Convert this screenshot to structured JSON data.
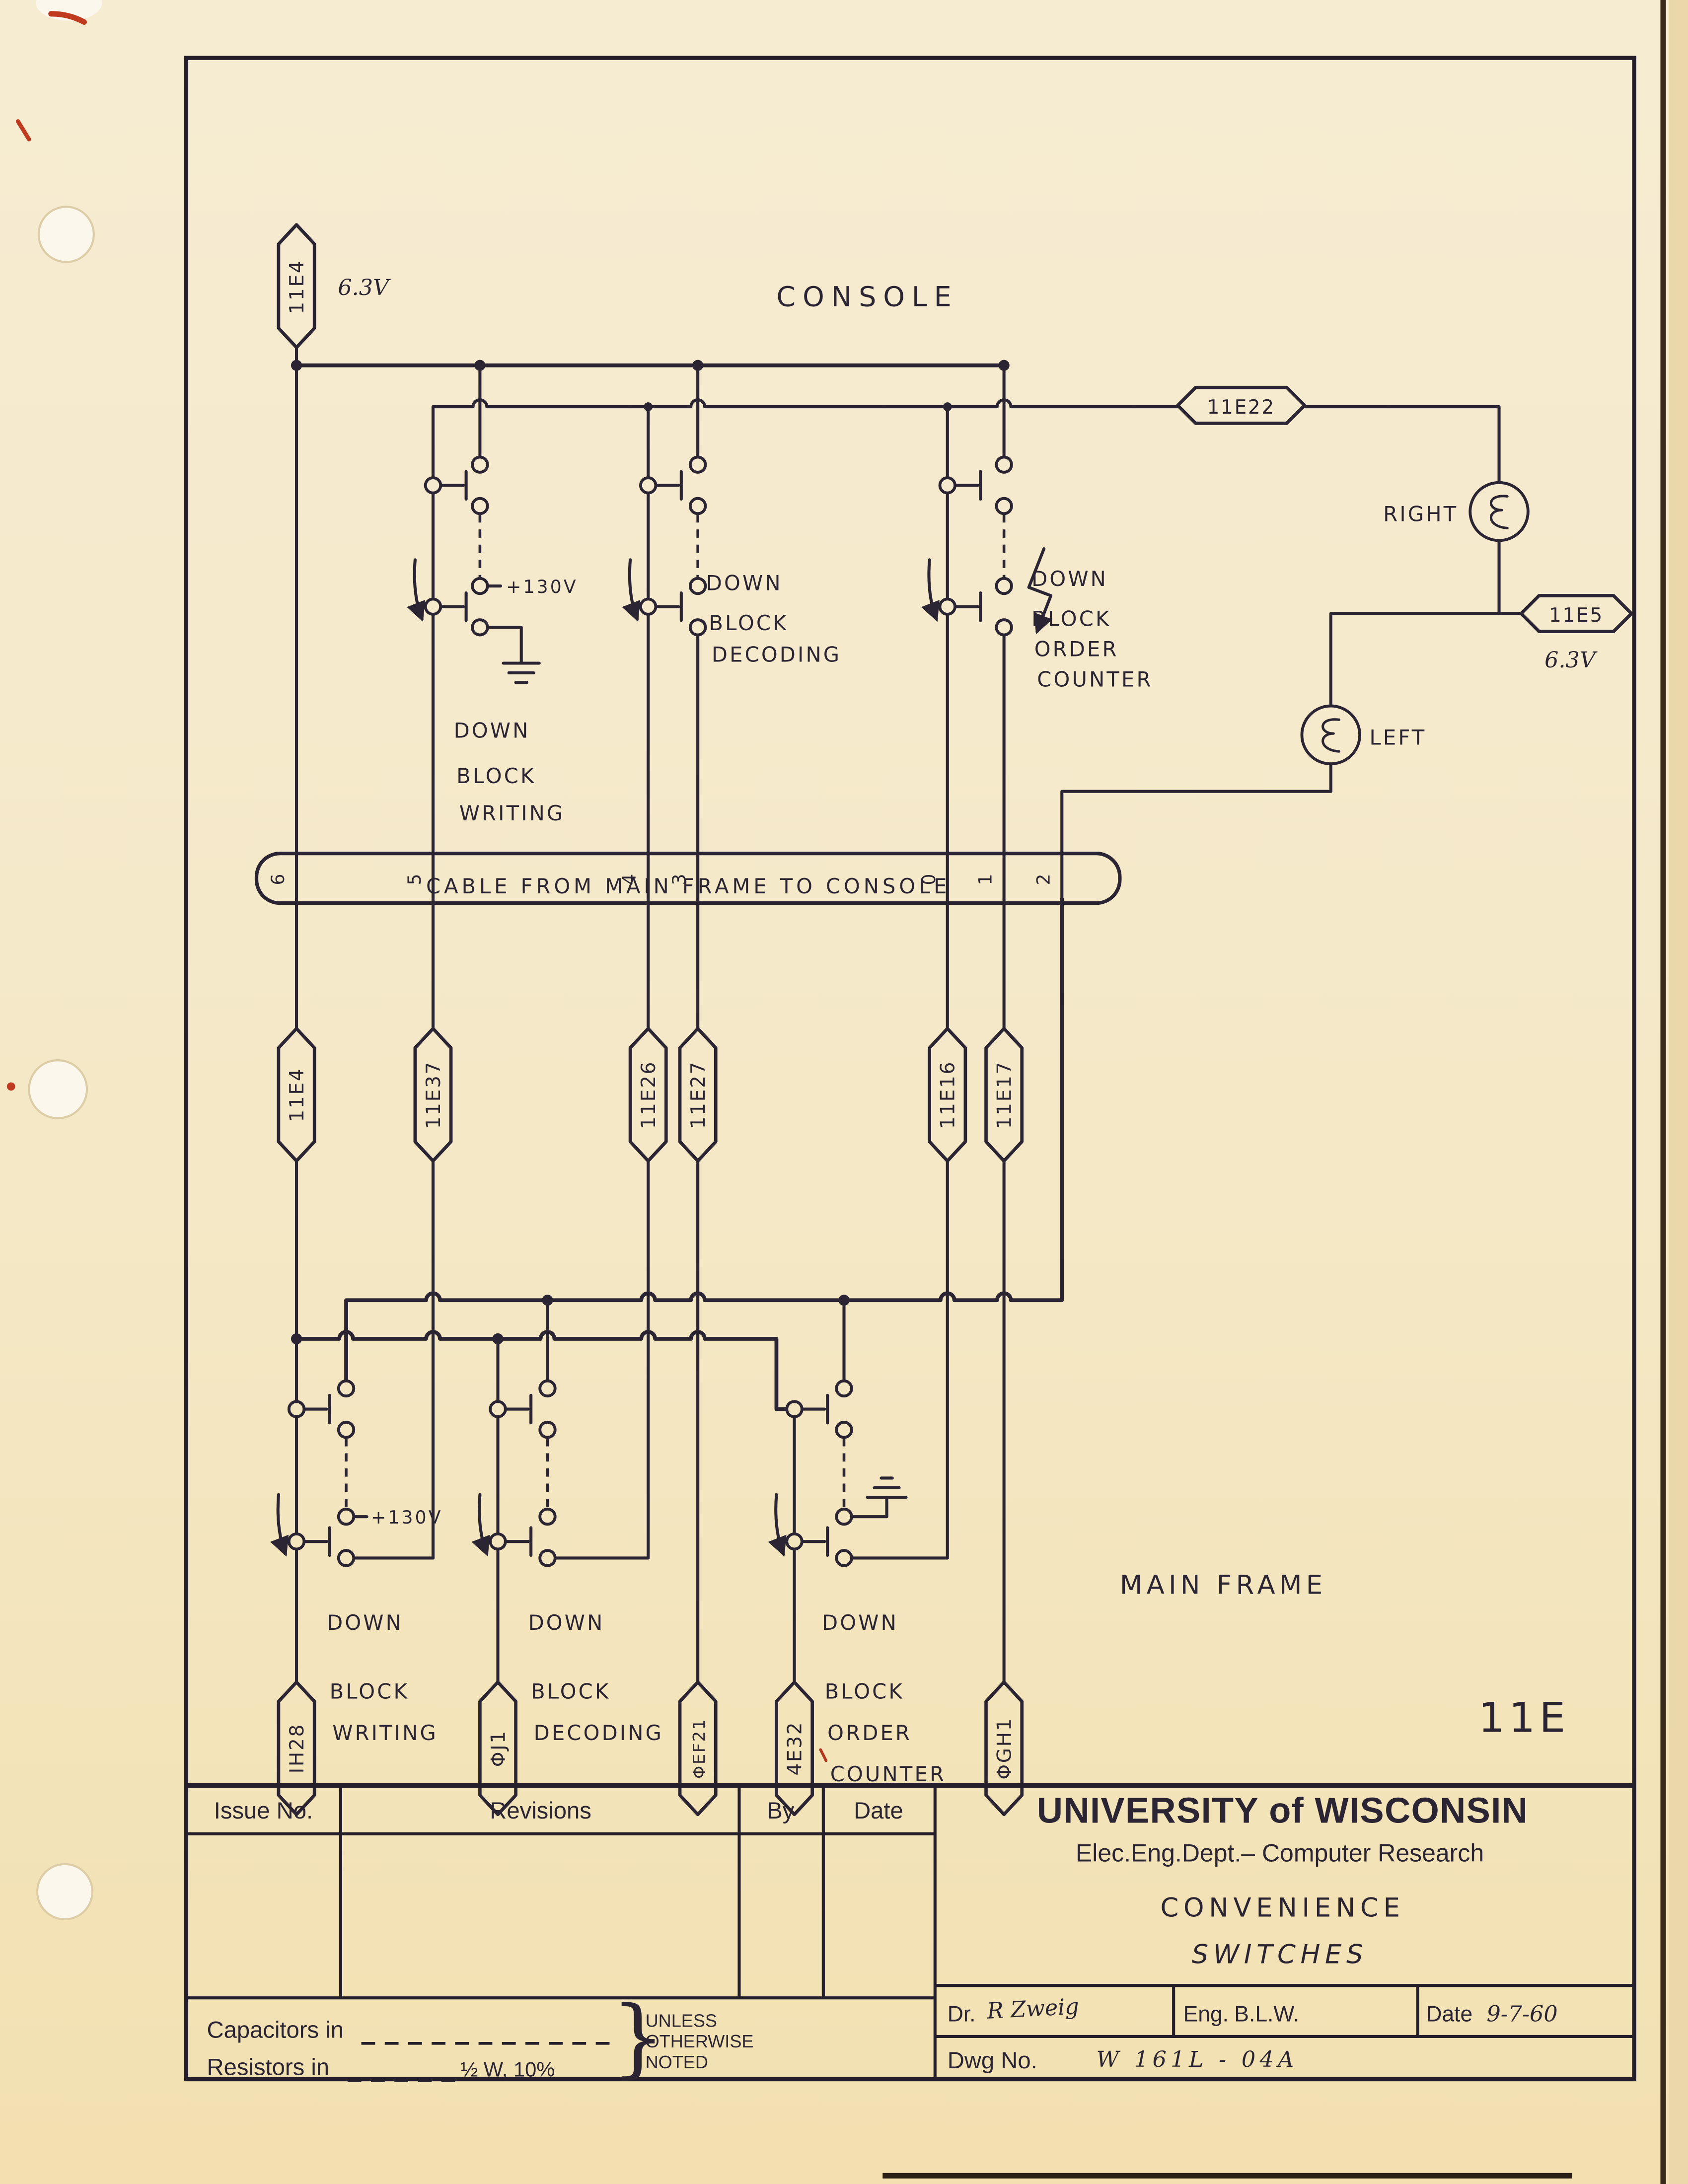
{
  "page": {
    "sheet_number": "11E",
    "console_label": "CONSOLE",
    "main_frame_label": "MAIN FRAME"
  },
  "colors": {
    "ink": "#2b2533",
    "paper": "#f4e8c8",
    "red_mark": "#bf3a1e"
  },
  "connectors": {
    "top": {
      "id": "11E4",
      "voltage": "6.3V"
    },
    "lamp_feed": {
      "id": "11E22"
    },
    "lamp_return": {
      "id": "11E5",
      "voltage": "6.3V"
    },
    "cable_row": [
      "11E4",
      "11E37",
      "11E26",
      "11E27",
      "11E16",
      "11E17"
    ],
    "bottom_row": [
      "IH28",
      "ΦJ1",
      "ΦEF21",
      "4E32",
      "ΦGH1"
    ]
  },
  "lamps": {
    "right": "RIGHT",
    "left": "LEFT"
  },
  "cable": {
    "label": "CABLE FROM MAIN FRAME TO CONSOLE",
    "pins": [
      "6",
      "5",
      "4",
      "3",
      "0",
      "1",
      "2"
    ]
  },
  "voltage_130": "+130V",
  "switch_groups": {
    "console": [
      {
        "lines": [
          "DOWN",
          "BLOCK",
          "WRITING"
        ]
      },
      {
        "lines": [
          "DOWN",
          "BLOCK",
          "DECODING"
        ]
      },
      {
        "lines": [
          "DOWN",
          "BLOCK",
          "ORDER",
          "COUNTER"
        ]
      }
    ],
    "main_frame": [
      {
        "lines": [
          "DOWN",
          "BLOCK",
          "WRITING"
        ]
      },
      {
        "lines": [
          "DOWN",
          "BLOCK",
          "DECODING"
        ]
      },
      {
        "lines": [
          "DOWN",
          "BLOCK",
          "ORDER",
          "COUNTER"
        ]
      }
    ]
  },
  "title_block": {
    "columns": [
      "Issue No.",
      "Revisions",
      "By",
      "Date"
    ],
    "university": "UNIVERSITY of WISCONSIN",
    "department": "Elec.Eng.Dept.– Computer Research",
    "title_line1": "CONVENIENCE",
    "title_line2": "SWITCHES",
    "dr_label": "Dr.",
    "dr_value": "R Zweig",
    "eng_label": "Eng.",
    "eng_value": "B.L.W.",
    "date_label": "Date",
    "date_value": "9-7-60",
    "dwg_label": "Dwg No.",
    "dwg_value": "W 161L - 04A",
    "notes": {
      "capacitors_label": "Capacitors in",
      "resistors_label": "Resistors in",
      "resistor_value": "½ W, 10%",
      "unless_lines": [
        "UNLESS",
        "OTHERWISE",
        "NOTED"
      ]
    }
  }
}
